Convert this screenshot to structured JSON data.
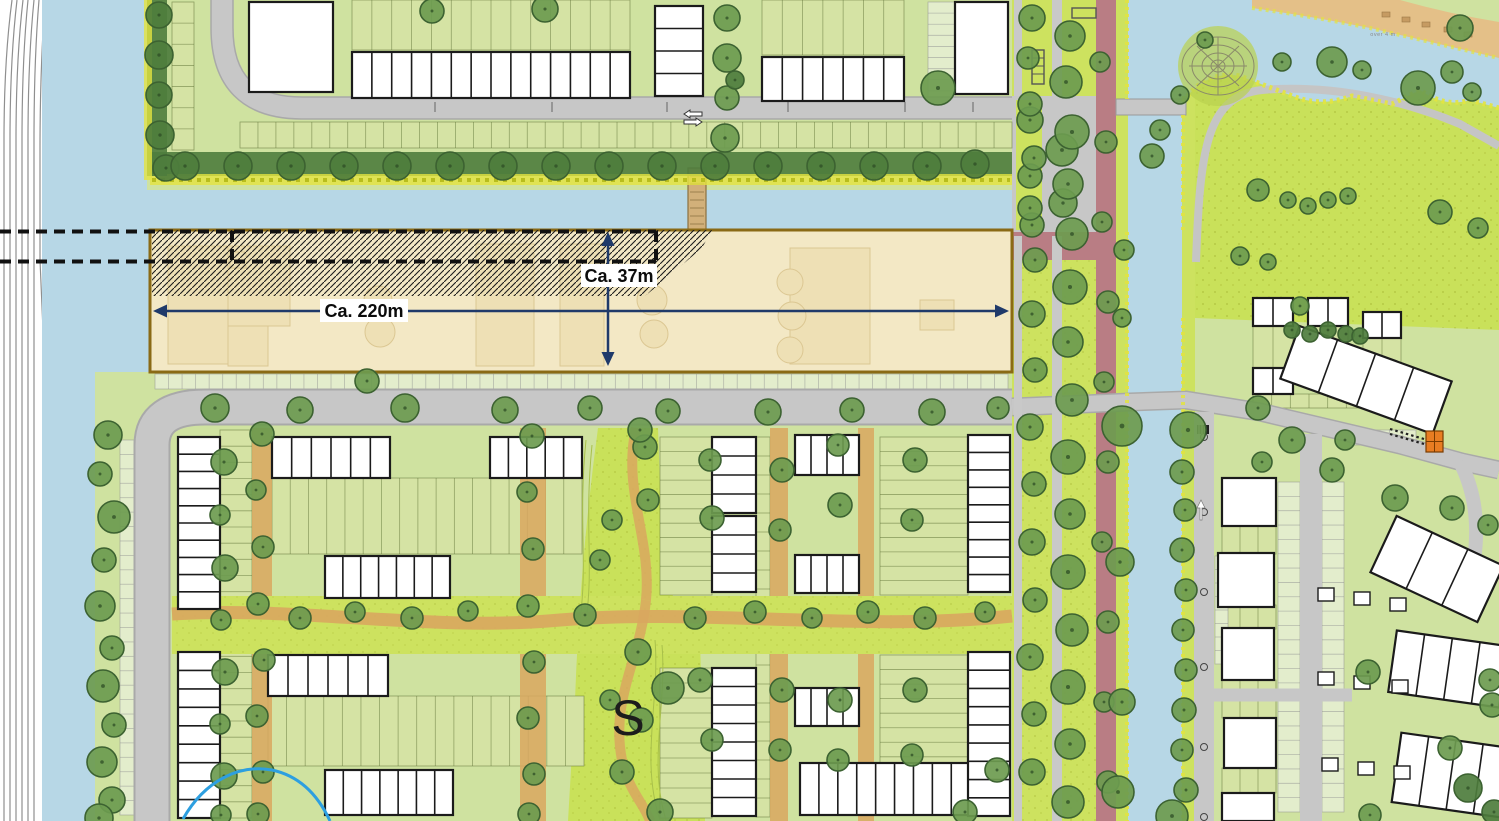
{
  "annotations": {
    "dim_width_label": "Ca. 220m",
    "dim_height_label": "Ca. 37m",
    "area_marker": "S",
    "water_note": "over 4 m"
  },
  "palette": {
    "water": "#b7d7e6",
    "rail_bg": "#ffffff",
    "rail_line": "#8f8f8f",
    "grass": "#cfe2a0",
    "grass_bright": "#cde25f",
    "park_speckle": "#c9e15a",
    "road": "#c7c7c7",
    "road_edge": "#a8a8a8",
    "sand": "#d9a75f",
    "sand_light": "#e4c088",
    "red_path": "#b97d84",
    "building": "#ffffff",
    "outline": "#1b1b1b",
    "tree": "#6d9b4f",
    "tree_edge": "#3c6231",
    "hedge": "#4e7d3d",
    "reed": "#e3e440",
    "beige": "#f3e8c5",
    "beige_border": "#8a6a15",
    "beige_inner": "#eedfb2",
    "beige_inner_line": "#d6bf86",
    "dim_arrow": "#1f3a6a",
    "label_text": "#0b0b0b",
    "dash_line": "#111111",
    "blue_line": "#2d9fe0",
    "orange": "#e87d22",
    "bay": "#e3edcc",
    "garden": "#d5e3a4"
  },
  "map_features": {
    "trees": [
      [
        159,
        15,
        13,
        1
      ],
      [
        159,
        55,
        14,
        1
      ],
      [
        159,
        95,
        13,
        1
      ],
      [
        160,
        135,
        14,
        1
      ],
      [
        166,
        168,
        13,
        1
      ],
      [
        185,
        166,
        14,
        1
      ],
      [
        238,
        166,
        14,
        1
      ],
      [
        291,
        166,
        14,
        1
      ],
      [
        344,
        166,
        14,
        1
      ],
      [
        397,
        166,
        14,
        1
      ],
      [
        450,
        166,
        14,
        1
      ],
      [
        503,
        166,
        14,
        1
      ],
      [
        556,
        166,
        14,
        1
      ],
      [
        609,
        166,
        14,
        1
      ],
      [
        662,
        166,
        14,
        1
      ],
      [
        715,
        166,
        14,
        1
      ],
      [
        768,
        166,
        14,
        1
      ],
      [
        821,
        166,
        14,
        1
      ],
      [
        874,
        166,
        14,
        1
      ],
      [
        927,
        166,
        14,
        1
      ],
      [
        975,
        164,
        14,
        1
      ],
      [
        432,
        11,
        12
      ],
      [
        545,
        9,
        13
      ],
      [
        727,
        18,
        13
      ],
      [
        727,
        58,
        14
      ],
      [
        727,
        98,
        12
      ],
      [
        725,
        138,
        14
      ],
      [
        938,
        88,
        17
      ],
      [
        735,
        80,
        9,
        1
      ],
      [
        1030,
        120,
        13
      ],
      [
        1062,
        150,
        16
      ],
      [
        1030,
        176,
        12
      ],
      [
        1063,
        203,
        14
      ],
      [
        1032,
        225,
        12
      ],
      [
        1032,
        18,
        13
      ],
      [
        1070,
        36,
        15
      ],
      [
        1028,
        58,
        11
      ],
      [
        1066,
        82,
        16
      ],
      [
        1030,
        104,
        12
      ],
      [
        1072,
        132,
        17
      ],
      [
        1034,
        158,
        12
      ],
      [
        1068,
        184,
        15
      ],
      [
        1030,
        208,
        12
      ],
      [
        1072,
        234,
        16
      ],
      [
        1035,
        260,
        12
      ],
      [
        1070,
        287,
        17
      ],
      [
        1032,
        314,
        13
      ],
      [
        1068,
        342,
        15
      ],
      [
        1035,
        370,
        12
      ],
      [
        1072,
        400,
        16
      ],
      [
        1030,
        427,
        13
      ],
      [
        1068,
        457,
        17
      ],
      [
        1034,
        484,
        12
      ],
      [
        1070,
        514,
        15
      ],
      [
        1032,
        542,
        13
      ],
      [
        1068,
        572,
        17
      ],
      [
        1035,
        600,
        12
      ],
      [
        1072,
        630,
        16
      ],
      [
        1030,
        657,
        13
      ],
      [
        1068,
        687,
        17
      ],
      [
        1034,
        714,
        12
      ],
      [
        1070,
        744,
        15
      ],
      [
        1032,
        772,
        13
      ],
      [
        1068,
        802,
        16
      ],
      [
        1100,
        62,
        10
      ],
      [
        1106,
        142,
        11
      ],
      [
        1102,
        222,
        10
      ],
      [
        1108,
        302,
        11
      ],
      [
        1104,
        382,
        10
      ],
      [
        1108,
        462,
        11
      ],
      [
        1102,
        542,
        10
      ],
      [
        1108,
        622,
        11
      ],
      [
        1104,
        702,
        10
      ],
      [
        1108,
        782,
        11
      ],
      [
        1122,
        426,
        20
      ],
      [
        1120,
        562,
        14
      ],
      [
        1122,
        702,
        13
      ],
      [
        1118,
        792,
        16
      ],
      [
        1124,
        250,
        10
      ],
      [
        1122,
        318,
        9
      ],
      [
        1188,
        430,
        18
      ],
      [
        1182,
        472,
        12
      ],
      [
        1185,
        510,
        11
      ],
      [
        1182,
        550,
        12
      ],
      [
        1186,
        590,
        11
      ],
      [
        1183,
        630,
        11
      ],
      [
        1186,
        670,
        11
      ],
      [
        1184,
        710,
        12
      ],
      [
        1182,
        750,
        11
      ],
      [
        1186,
        790,
        12
      ],
      [
        1172,
        816,
        16
      ],
      [
        108,
        435,
        14
      ],
      [
        100,
        474,
        12
      ],
      [
        114,
        517,
        16
      ],
      [
        104,
        560,
        12
      ],
      [
        100,
        606,
        15
      ],
      [
        112,
        648,
        12
      ],
      [
        103,
        686,
        16
      ],
      [
        114,
        725,
        12
      ],
      [
        102,
        762,
        15
      ],
      [
        112,
        800,
        13
      ],
      [
        99,
        818,
        14
      ],
      [
        224,
        462,
        13
      ],
      [
        220,
        515,
        10
      ],
      [
        225,
        568,
        13
      ],
      [
        221,
        620,
        10
      ],
      [
        225,
        672,
        13
      ],
      [
        220,
        724,
        10
      ],
      [
        224,
        776,
        13
      ],
      [
        221,
        815,
        10
      ],
      [
        215,
        408,
        14
      ],
      [
        300,
        410,
        13
      ],
      [
        405,
        408,
        14
      ],
      [
        505,
        410,
        13
      ],
      [
        590,
        408,
        12
      ],
      [
        668,
        411,
        12
      ],
      [
        768,
        412,
        13
      ],
      [
        852,
        410,
        12
      ],
      [
        932,
        412,
        13
      ],
      [
        998,
        408,
        11
      ],
      [
        367,
        381,
        12
      ],
      [
        262,
        434,
        12
      ],
      [
        256,
        490,
        10
      ],
      [
        263,
        547,
        11
      ],
      [
        258,
        604,
        11
      ],
      [
        264,
        660,
        11
      ],
      [
        257,
        716,
        11
      ],
      [
        263,
        772,
        11
      ],
      [
        258,
        814,
        11
      ],
      [
        532,
        436,
        12
      ],
      [
        527,
        492,
        10
      ],
      [
        533,
        549,
        11
      ],
      [
        528,
        606,
        11
      ],
      [
        534,
        662,
        11
      ],
      [
        528,
        718,
        11
      ],
      [
        534,
        774,
        11
      ],
      [
        529,
        814,
        11
      ],
      [
        300,
        618,
        11
      ],
      [
        355,
        612,
        10
      ],
      [
        412,
        618,
        11
      ],
      [
        468,
        611,
        10
      ],
      [
        585,
        615,
        11
      ],
      [
        695,
        618,
        11
      ],
      [
        755,
        612,
        11
      ],
      [
        812,
        618,
        10
      ],
      [
        868,
        612,
        11
      ],
      [
        925,
        618,
        11
      ],
      [
        985,
        612,
        10
      ],
      [
        645,
        447,
        12
      ],
      [
        612,
        520,
        10
      ],
      [
        600,
        560,
        10
      ],
      [
        648,
        500,
        11
      ],
      [
        638,
        652,
        13
      ],
      [
        668,
        688,
        16
      ],
      [
        641,
        720,
        12
      ],
      [
        610,
        700,
        10
      ],
      [
        622,
        772,
        12
      ],
      [
        660,
        812,
        13
      ],
      [
        640,
        430,
        12
      ],
      [
        710,
        460,
        11
      ],
      [
        712,
        518,
        12
      ],
      [
        782,
        470,
        12
      ],
      [
        780,
        530,
        11
      ],
      [
        838,
        445,
        11
      ],
      [
        840,
        505,
        12
      ],
      [
        915,
        460,
        12
      ],
      [
        912,
        520,
        11
      ],
      [
        700,
        680,
        12
      ],
      [
        712,
        740,
        11
      ],
      [
        782,
        690,
        12
      ],
      [
        780,
        750,
        11
      ],
      [
        840,
        700,
        12
      ],
      [
        838,
        760,
        11
      ],
      [
        915,
        690,
        12
      ],
      [
        912,
        755,
        11
      ],
      [
        965,
        812,
        12
      ],
      [
        997,
        770,
        12
      ],
      [
        1160,
        130,
        10
      ],
      [
        1152,
        156,
        12
      ],
      [
        1282,
        62,
        9
      ],
      [
        1332,
        62,
        15
      ],
      [
        1362,
        70,
        9
      ],
      [
        1418,
        88,
        17
      ],
      [
        1452,
        72,
        11
      ],
      [
        1472,
        92,
        9
      ],
      [
        1258,
        190,
        11
      ],
      [
        1288,
        200,
        8
      ],
      [
        1308,
        206,
        8
      ],
      [
        1328,
        200,
        8
      ],
      [
        1348,
        196,
        8
      ],
      [
        1240,
        256,
        9
      ],
      [
        1268,
        262,
        8
      ],
      [
        1460,
        28,
        13
      ],
      [
        1180,
        95,
        9
      ],
      [
        1205,
        40,
        8
      ],
      [
        1292,
        440,
        13
      ],
      [
        1332,
        470,
        12
      ],
      [
        1395,
        498,
        13
      ],
      [
        1452,
        508,
        12
      ],
      [
        1488,
        525,
        10
      ],
      [
        1368,
        672,
        12
      ],
      [
        1450,
        748,
        12
      ],
      [
        1370,
        815,
        11
      ],
      [
        1490,
        680,
        11
      ],
      [
        1258,
        408,
        12
      ],
      [
        1345,
        440,
        10
      ],
      [
        1262,
        462,
        10
      ],
      [
        1492,
        705,
        12
      ],
      [
        1468,
        788,
        14,
        1
      ],
      [
        1494,
        812,
        12,
        1
      ],
      [
        1478,
        228,
        10
      ],
      [
        1440,
        212,
        12
      ],
      [
        1292,
        330,
        8,
        1
      ],
      [
        1310,
        334,
        8,
        1
      ],
      [
        1328,
        330,
        8,
        1
      ],
      [
        1346,
        334,
        8,
        1
      ],
      [
        1300,
        306,
        9
      ],
      [
        1360,
        336,
        8,
        1
      ]
    ],
    "housing": [
      [
        352,
        52,
        278,
        46,
        14
      ],
      [
        655,
        6,
        48,
        90,
        4,
        "v"
      ],
      [
        762,
        57,
        142,
        44,
        7
      ],
      [
        249,
        2,
        84,
        90,
        1
      ],
      [
        955,
        2,
        53,
        92,
        1
      ],
      [
        178,
        437,
        42,
        172,
        10,
        "v"
      ],
      [
        178,
        652,
        42,
        166,
        9,
        "v"
      ],
      [
        272,
        437,
        118,
        41,
        6
      ],
      [
        325,
        556,
        125,
        42,
        7
      ],
      [
        490,
        437,
        92,
        41,
        5
      ],
      [
        268,
        655,
        120,
        41,
        6
      ],
      [
        325,
        770,
        128,
        45,
        7
      ],
      [
        712,
        437,
        44,
        76,
        4,
        "v"
      ],
      [
        712,
        516,
        44,
        76,
        4,
        "v"
      ],
      [
        795,
        435,
        64,
        40,
        4
      ],
      [
        795,
        555,
        64,
        38,
        4
      ],
      [
        968,
        435,
        42,
        157,
        9,
        "v"
      ],
      [
        712,
        668,
        44,
        148,
        8,
        "v"
      ],
      [
        795,
        688,
        64,
        38,
        4
      ],
      [
        800,
        763,
        208,
        52,
        11
      ],
      [
        968,
        652,
        42,
        164,
        9,
        "v"
      ],
      [
        1222,
        478,
        54,
        48,
        1
      ],
      [
        1218,
        553,
        56,
        54,
        1
      ],
      [
        1222,
        628,
        52,
        52,
        1
      ],
      [
        1224,
        718,
        52,
        50,
        1
      ],
      [
        1222,
        793,
        52,
        28,
        1
      ],
      [
        1253,
        298,
        40,
        28,
        2
      ],
      [
        1308,
        298,
        40,
        28,
        2
      ],
      [
        1363,
        312,
        38,
        26,
        2
      ],
      [
        1253,
        368,
        40,
        26,
        2
      ],
      [
        1365,
        368,
        36,
        24,
        2
      ],
      [
        1285,
        352,
        162,
        56,
        4,
        "h",
        20
      ],
      [
        1378,
        538,
        118,
        62,
        3,
        "h",
        25
      ],
      [
        1392,
        638,
        112,
        62,
        4,
        "h",
        8
      ],
      [
        1396,
        740,
        110,
        70,
        4,
        "h",
        8
      ]
    ],
    "gardens": [
      [
        352,
        0,
        278,
        50,
        14,
        "v"
      ],
      [
        762,
        0,
        142,
        55,
        7,
        "v"
      ],
      [
        240,
        122,
        772,
        26,
        43,
        "v"
      ],
      [
        172,
        2,
        22,
        148,
        7,
        "h"
      ],
      [
        272,
        478,
        310,
        76,
        17,
        "v"
      ],
      [
        268,
        696,
        316,
        70,
        17,
        "v"
      ],
      [
        660,
        437,
        52,
        158,
        11,
        "h"
      ],
      [
        880,
        437,
        88,
        158,
        11,
        "h"
      ],
      [
        660,
        668,
        52,
        150,
        10,
        "h"
      ],
      [
        880,
        655,
        88,
        160,
        11,
        "h"
      ],
      [
        220,
        430,
        32,
        388,
        24,
        "h"
      ],
      [
        756,
        437,
        14,
        380,
        20,
        "h"
      ],
      [
        1222,
        526,
        54,
        28,
        3,
        "v"
      ],
      [
        1222,
        605,
        54,
        24,
        3,
        "v"
      ],
      [
        1222,
        680,
        54,
        38,
        3,
        "v"
      ],
      [
        1222,
        768,
        54,
        25,
        3,
        "v"
      ],
      [
        1253,
        326,
        40,
        42,
        2,
        "v"
      ],
      [
        1308,
        326,
        40,
        42,
        2,
        "v"
      ],
      [
        1363,
        338,
        38,
        30,
        2,
        "v"
      ],
      [
        1253,
        394,
        112,
        14,
        6,
        "v"
      ]
    ],
    "parking": [
      [
        155,
        374,
        853,
        15,
        63,
        "v"
      ],
      [
        120,
        440,
        14,
        375,
        26,
        "h"
      ],
      [
        1278,
        482,
        22,
        330,
        23,
        "h"
      ],
      [
        1322,
        482,
        22,
        330,
        23,
        "h"
      ],
      [
        928,
        2,
        27,
        100,
        9,
        "h"
      ],
      [
        1350,
        430,
        66,
        15,
        5,
        "v"
      ],
      [
        1215,
        556,
        13,
        108,
        8,
        "h"
      ]
    ],
    "sheds": [
      [
        1318,
        588
      ],
      [
        1354,
        592
      ],
      [
        1390,
        598
      ],
      [
        1318,
        672
      ],
      [
        1354,
        676
      ],
      [
        1392,
        680
      ],
      [
        1322,
        758
      ],
      [
        1358,
        762
      ],
      [
        1394,
        766
      ]
    ]
  }
}
